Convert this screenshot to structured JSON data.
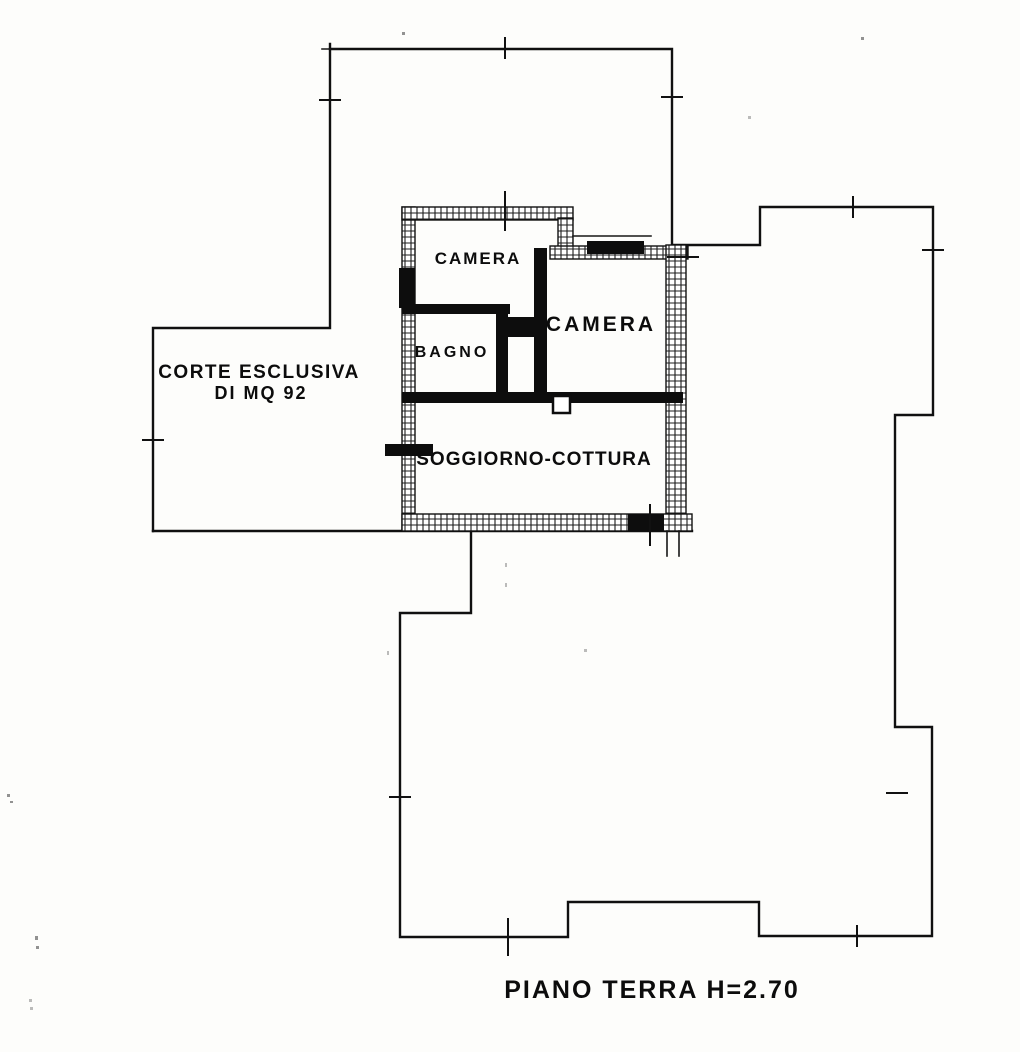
{
  "meta": {
    "ink_color": "#0d0d0d",
    "paper_color": "#fdfdfb",
    "drawing_type": "floor-plan-scan"
  },
  "plan": {
    "rooms": [
      {
        "id": "camera-1",
        "label": "CAMERA"
      },
      {
        "id": "bagno",
        "label": "BAGNO"
      },
      {
        "id": "camera-2",
        "label": "CAMERA"
      },
      {
        "id": "soggiorno-cottura",
        "label": "SOGGIORNO-COTTURA"
      }
    ],
    "courtyard": {
      "line1": "CORTE ESCLUSIVA",
      "line2": "DI MQ 92"
    },
    "caption": "PIANO TERRA H=2.70"
  }
}
